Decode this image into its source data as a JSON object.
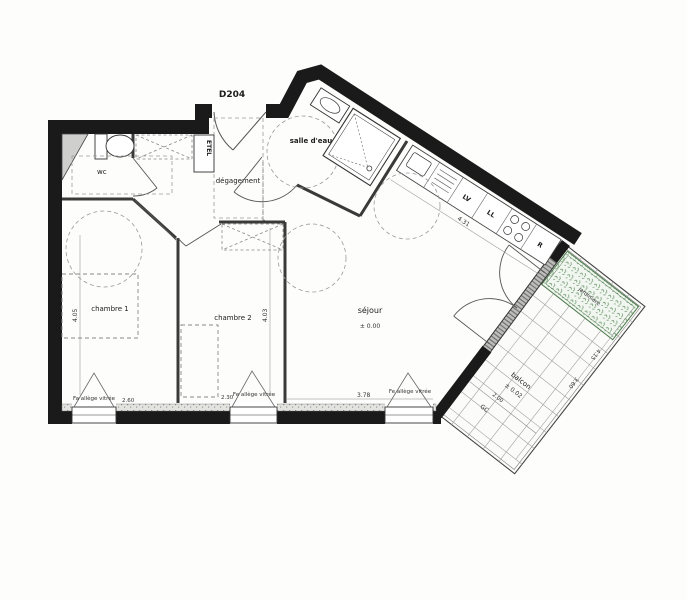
{
  "labels": {
    "unit": "D204",
    "wc": "wc",
    "degagement": "dégagement",
    "salle_eau": "salle d'eau",
    "chambre1": "chambre 1",
    "chambre2": "chambre 2",
    "sejour": "séjour",
    "sejour_level": "± 0.00",
    "balcon": "balcon",
    "balcon_level": "± 0.02",
    "etel": "ETEL",
    "lv": "LV",
    "ll": "LL",
    "r": "R",
    "gc": "GC",
    "planter": "jardinière"
  },
  "windows": {
    "w1": "Fa allège vitrée",
    "w2": "Fe allège vitrée",
    "w3": "Fe allège vitrée"
  },
  "dimensions": {
    "chambre1_depth": "4.05",
    "chambre1_width": "2.60",
    "chambre2_depth": "4.03",
    "chambre2_width": "2.30",
    "sejour_width": "3.78",
    "kitchen_wall": "4.31",
    "balcon_depth": "2.00",
    "balcon_edge_a": "4.15",
    "balcon_edge_b": "3.60"
  },
  "colors": {
    "wall": "#1a1a1a",
    "plant_green": "#6f9e6f"
  }
}
